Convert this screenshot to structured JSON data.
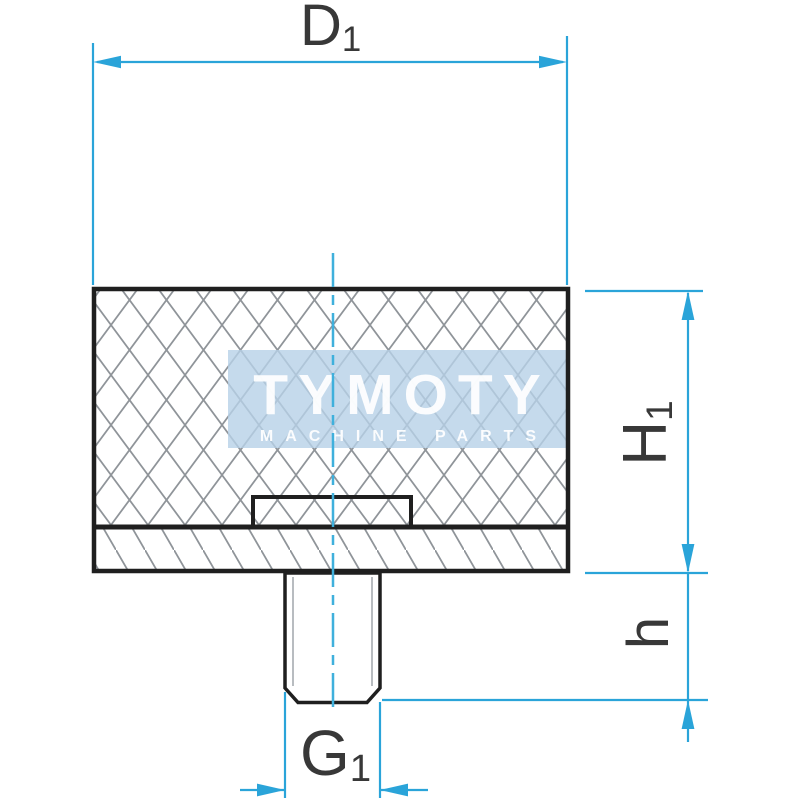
{
  "watermark": {
    "brand": "TYMOTY",
    "tagline": "MACHINE PARTS"
  },
  "labels": {
    "diameter": {
      "base": "D",
      "sub": "1"
    },
    "body_height": {
      "base": "H",
      "sub": "1"
    },
    "stud_height": {
      "base": "h",
      "sub": ""
    },
    "thread": {
      "base": "G",
      "sub": "1"
    }
  },
  "colors": {
    "dimension_line": "#2aa4d9",
    "centerline": "#3fb0dc",
    "outline": "#1f1f1f",
    "hatch": "#8f9499",
    "watermark_bg": "#b7d1e7",
    "watermark_text": "#ffffff",
    "label_text": "#383838",
    "background": "#ffffff"
  }
}
